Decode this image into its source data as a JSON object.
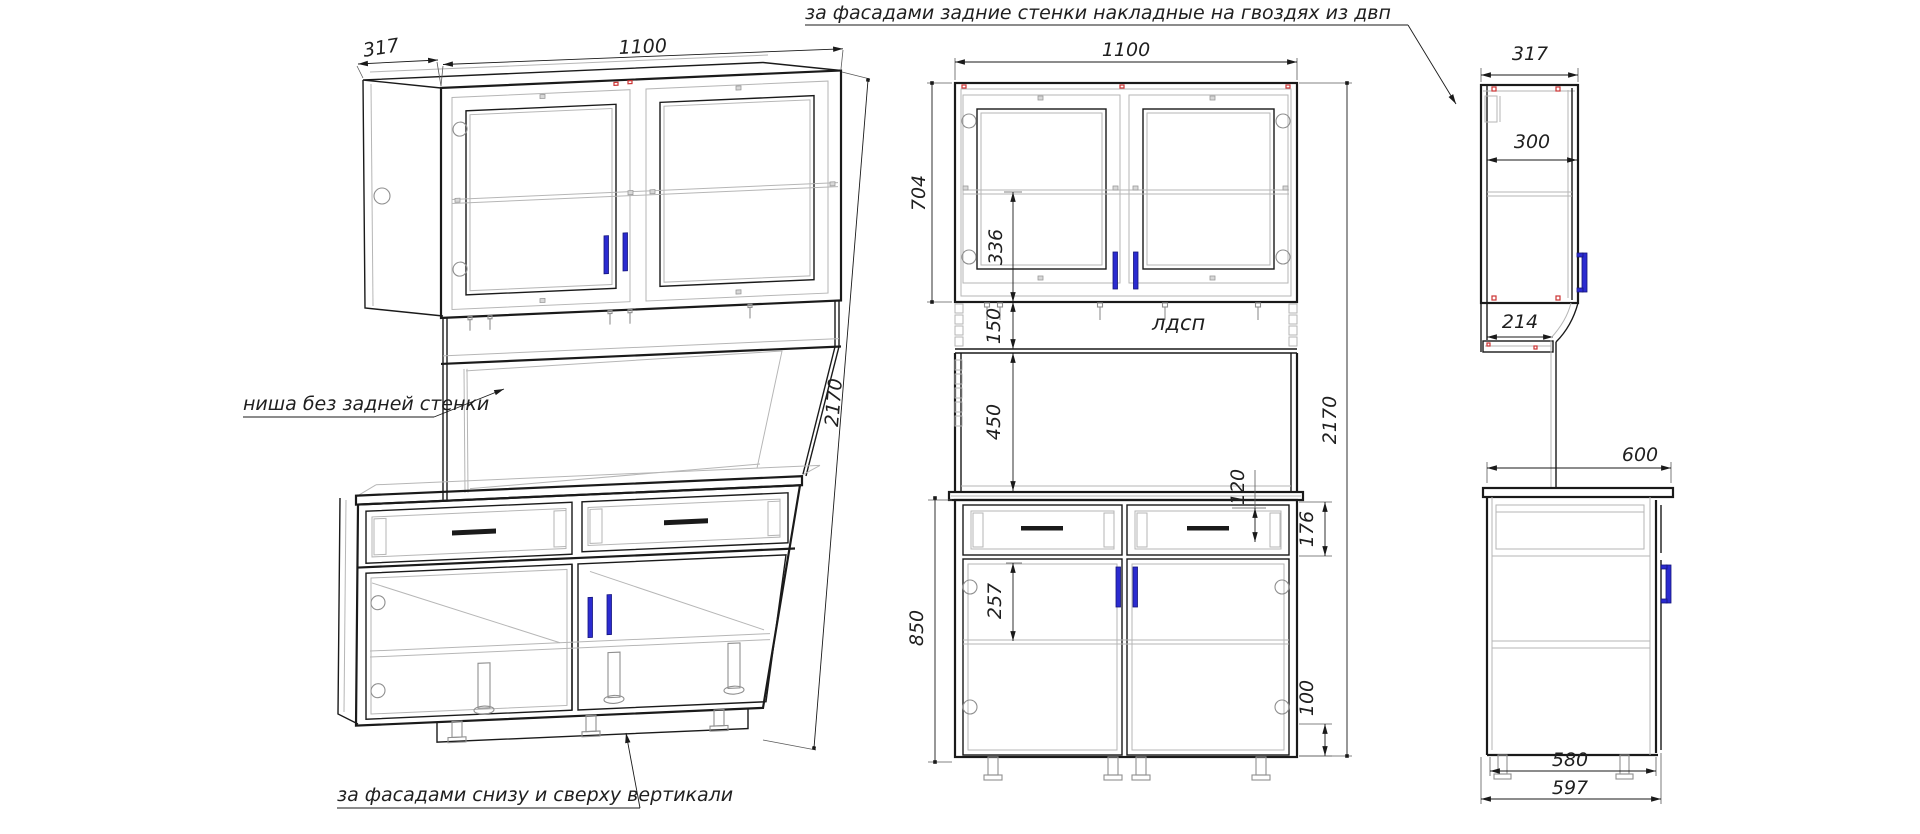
{
  "notes": {
    "top": "за фасадами задние стенки накладные на гвоздях из двп",
    "niche": "ниша без задней стенки",
    "bottom": "за фасадами снизу и сверху вертикали",
    "material": "лдсп"
  },
  "iso": {
    "depth": "317",
    "width": "1100",
    "height": "2170"
  },
  "front": {
    "width": "1100",
    "upper_height": "704",
    "shelf_offset": "336",
    "gap": "150",
    "niche_height": "450",
    "drawer_inner": "120",
    "drawer_front": "176",
    "door_offset": "257",
    "lower_height": "850",
    "plinth": "100",
    "total_height": "2170"
  },
  "side": {
    "depth": "317",
    "inner_depth": "300",
    "shelf_depth": "214",
    "worktop_depth": "600",
    "body_depth": "580",
    "total_depth": "597"
  },
  "colors": {
    "handle": "#2b2bd0",
    "fastener": "#cc3333"
  }
}
